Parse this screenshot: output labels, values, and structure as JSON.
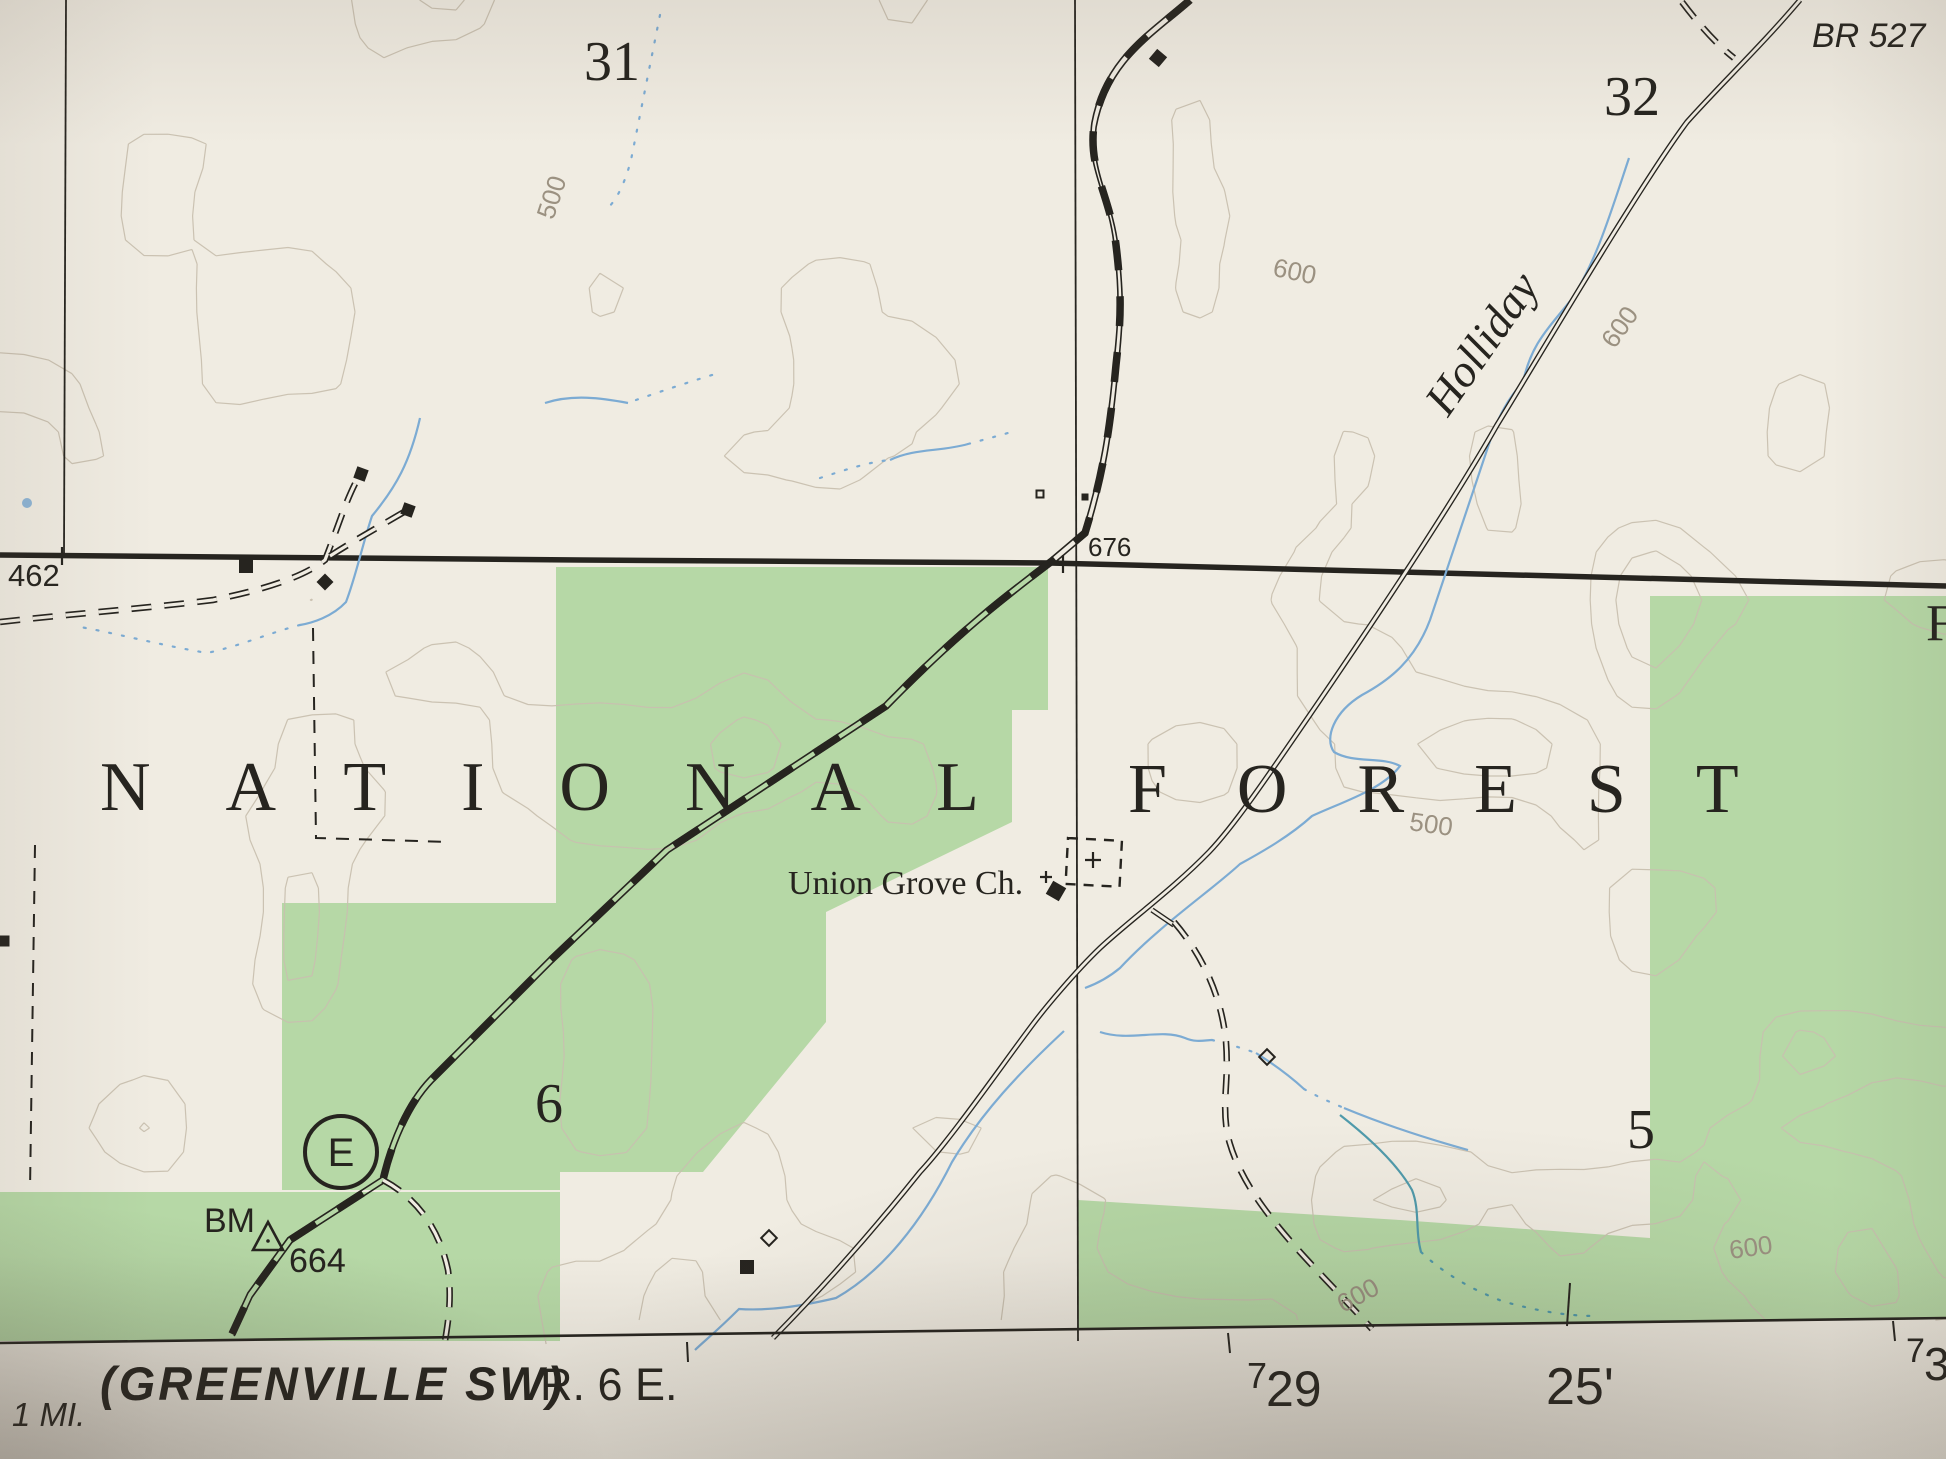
{
  "map": {
    "colors": {
      "paper": "#f0ece2",
      "paper_margin": "#efece3",
      "forest_green": "#b6d8a6",
      "contour": "#c8c0af",
      "contour_index": "#a89d89",
      "contour_label": "#9b9181",
      "water": "#7cabd3",
      "water_teal": "#4f9aab",
      "ink": "#26241f"
    },
    "contour_field": {
      "seed": 11,
      "step": 24,
      "wavelength": 150,
      "levels": [
        0.34,
        0.42,
        0.5,
        0.58,
        0.66
      ],
      "index_level": 2
    },
    "forest_areas": [
      {
        "name": "forest-area-central",
        "points": [
          [
            556,
            567
          ],
          [
            1048,
            567
          ],
          [
            1048,
            710
          ],
          [
            1012,
            710
          ],
          [
            1012,
            822
          ],
          [
            826,
            912
          ],
          [
            826,
            1022
          ],
          [
            703,
            1172
          ],
          [
            556,
            1172
          ]
        ]
      },
      {
        "name": "forest-area-west-column",
        "points": [
          [
            282,
            903
          ],
          [
            560,
            903
          ],
          [
            560,
            1190
          ],
          [
            282,
            1190
          ]
        ]
      },
      {
        "name": "forest-area-southwest-band",
        "points": [
          [
            0,
            1192
          ],
          [
            560,
            1192
          ],
          [
            560,
            1341
          ],
          [
            0,
            1341
          ]
        ]
      },
      {
        "name": "forest-area-east",
        "points": [
          [
            1650,
            596
          ],
          [
            1946,
            596
          ],
          [
            1946,
            1240
          ],
          [
            1650,
            1240
          ]
        ]
      },
      {
        "name": "forest-area-southeast-band",
        "points": [
          [
            1078,
            1200
          ],
          [
            1400,
            1220
          ],
          [
            1650,
            1238
          ],
          [
            1946,
            1238
          ],
          [
            1946,
            1318
          ],
          [
            1078,
            1330
          ]
        ]
      }
    ],
    "lines": [
      {
        "name": "landline-heavy",
        "cls": "heavy",
        "d": "M0,555 L580,560 L1050,563 L1946,586"
      },
      {
        "name": "section-line-west",
        "cls": "thin",
        "d": "M66,0 L64,553"
      },
      {
        "name": "section-line-central",
        "cls": "thin",
        "d": "M1075,0 L1078,1341"
      },
      {
        "name": "boundary-dashed-west",
        "cls": "dashbound",
        "d": "M35,845 L30,1190"
      },
      {
        "name": "boundary-dashed-mid",
        "cls": "dashbound",
        "d": "M313,628 L316,838 L450,842"
      },
      {
        "name": "stream-upper-left",
        "cls": "stream-int",
        "d": "M660,15 C651,60 641,110 631,160 C623,190 613,205 604,211"
      },
      {
        "name": "stream-left",
        "cls": "stream",
        "d": "M420,418 C410,462 396,487 372,516 C362,546 356,576 346,602 C332,617 312,623 300,625"
      },
      {
        "name": "stream-left-dotted",
        "cls": "stream-int",
        "d": "M300,625 C272,632 240,646 207,653 C160,645 110,632 80,627"
      },
      {
        "name": "stream-center-small",
        "cls": "stream",
        "d": "M545,403 C572,394 602,398 628,403"
      },
      {
        "name": "stream-center-dotted",
        "cls": "stream-int",
        "d": "M636,400 C665,390 695,380 722,372"
      },
      {
        "name": "stream-mid",
        "cls": "stream",
        "d": "M890,460 C915,448 940,452 968,444"
      },
      {
        "name": "stream-mid-dotted",
        "cls": "stream-int",
        "d": "M820,478 C845,470 868,462 890,460 M968,444 C990,438 1005,434 1018,430"
      },
      {
        "name": "stream-holliday",
        "cls": "stream",
        "d": "M1629,158 C1610,215 1596,262 1571,300 C1546,331 1531,345 1523,382 C1507,400 1500,415 1493,432 C1470,500 1450,560 1430,620 C1415,660 1390,680 1362,695 C1334,712 1324,738 1334,752 C1354,764 1382,756 1400,766 C1382,790 1342,802 1312,816 C1290,836 1262,852 1240,864 C1212,890 1160,925 1120,968 C1108,978 1096,984 1085,988"
      },
      {
        "name": "stream-road-bottom",
        "cls": "stream",
        "d": "M1064,1031 C1020,1072 982,1112 952,1162 C922,1222 882,1272 836,1298 C802,1306 770,1311 739,1309 C717,1331 702,1343 695,1350"
      },
      {
        "name": "stream-east-wavy",
        "cls": "stream",
        "d": "M1100,1032 C1130,1042 1160,1028 1185,1038 C1196,1043 1206,1040 1212,1040"
      },
      {
        "name": "stream-east-dots-1",
        "cls": "stream-int",
        "d": "M1212,1040 C1228,1044 1242,1048 1256,1053"
      },
      {
        "name": "stream-east-2",
        "cls": "stream",
        "d": "M1256,1053 C1275,1065 1292,1078 1304,1089"
      },
      {
        "name": "stream-east-dots-2",
        "cls": "stream-int",
        "d": "M1304,1089 C1318,1097 1330,1102 1344,1108"
      },
      {
        "name": "stream-east-3",
        "cls": "stream",
        "d": "M1344,1108 C1385,1125 1425,1138 1468,1150"
      },
      {
        "name": "stream-green-teal",
        "cls": "stream-teal",
        "d": "M1340,1115 C1372,1140 1398,1165 1412,1190 C1420,1210 1415,1230 1421,1252"
      },
      {
        "name": "stream-green-teal-2",
        "cls": "stream-teal-int",
        "d": "M1421,1252 C1442,1272 1470,1289 1502,1301 C1540,1312 1570,1316 1596,1316"
      },
      {
        "name": "railroad",
        "cls": "railroad",
        "d": "M1190,0 C1150,35 1106,60 1094,125 C1088,170 1110,195 1116,245 C1122,295 1121,320 1116,365 C1110,430 1103,475 1085,533 L1052,561 C1010,593 960,630 886,706 L667,850 L553,958 L431,1080 C407,1105 391,1145 383,1180 L290,1240 L250,1295 L232,1334"
      },
      {
        "name": "road-holliday",
        "cls": "road",
        "d": "M1800,0 C1762,45 1720,85 1687,122 C1640,185 1540,355 1497,425 C1460,490 1395,590 1320,700 C1270,773 1235,825 1209,852 C1172,890 1130,920 1100,948 C1075,972 1045,1008 1033,1024 C1000,1068 950,1140 920,1172 C880,1222 830,1280 773,1338"
      },
      {
        "name": "road-spur-church",
        "cls": "road",
        "d": "M1152,910 L1174,925"
      },
      {
        "name": "road-unimproved-top",
        "cls": "droad",
        "d": "M1682,2 C1697,22 1716,44 1734,58"
      },
      {
        "name": "road-unimproved-east",
        "cls": "droad",
        "d": "M1174,922 C1205,958 1222,1000 1226,1042 C1229,1082 1222,1100 1227,1132 C1232,1158 1247,1185 1263,1207 C1292,1247 1330,1283 1372,1329"
      },
      {
        "name": "road-unimproved-west",
        "cls": "droad",
        "d": "M0,622 C80,613 150,608 213,600 C262,590 302,578 325,560 C337,530 345,502 358,478"
      },
      {
        "name": "road-unimproved-west-branch",
        "cls": "droad",
        "d": "M330,556 C355,540 382,525 404,512"
      },
      {
        "name": "road-unimproved-rr-branch",
        "cls": "droad",
        "d": "M383,1180 C420,1200 440,1232 448,1270 C452,1300 448,1322 445,1341"
      }
    ],
    "buildings": [
      {
        "name": "building",
        "x": 1158,
        "y": 58,
        "s": 11,
        "rot": 40,
        "filled": true
      },
      {
        "name": "building",
        "x": 361,
        "y": 474,
        "s": 10,
        "rot": 20,
        "filled": true
      },
      {
        "name": "building",
        "x": 408,
        "y": 510,
        "s": 10,
        "rot": 20,
        "filled": true
      },
      {
        "name": "building",
        "x": 325,
        "y": 582,
        "s": 10,
        "rot": 45,
        "filled": true
      },
      {
        "name": "building",
        "x": 246,
        "y": 566,
        "s": 12,
        "rot": 0,
        "filled": true
      },
      {
        "name": "building",
        "x": 747,
        "y": 1267,
        "s": 12,
        "rot": 0,
        "filled": true
      },
      {
        "name": "building-church",
        "x": 1056,
        "y": 891,
        "s": 13,
        "rot": 30,
        "filled": true
      },
      {
        "name": "building-open",
        "x": 769,
        "y": 1238,
        "s": 11,
        "rot": 45,
        "filled": false
      },
      {
        "name": "building-open",
        "x": 1267,
        "y": 1057,
        "s": 11,
        "rot": 45,
        "filled": false
      },
      {
        "name": "building-open",
        "x": 1040,
        "y": 494,
        "s": 7,
        "rot": 0,
        "filled": false
      },
      {
        "name": "building-small",
        "x": 1085,
        "y": 497,
        "s": 5,
        "rot": 0,
        "filled": true
      },
      {
        "name": "building-small",
        "x": 4,
        "y": 941,
        "s": 9,
        "rot": 0,
        "filled": true
      }
    ],
    "crosses": [
      {
        "name": "section-corner-cross",
        "x": 62,
        "y": 556,
        "s": 9
      },
      {
        "name": "section-corner-cross",
        "x": 1063,
        "y": 564,
        "s": 9
      },
      {
        "name": "cemetery-cross",
        "x": 1093,
        "y": 860,
        "s": 8
      },
      {
        "name": "church-cross",
        "x": 1046,
        "y": 877,
        "s": 6
      }
    ],
    "cemetery": {
      "name": "cemetery-outline",
      "x": 1068,
      "y": 838,
      "w": 54,
      "h": 46,
      "rot": 3
    },
    "route_marker": {
      "name": "route-marker-E",
      "cx": 341,
      "cy": 1152,
      "r": 36,
      "label": "E"
    },
    "benchmark_triangle": {
      "name": "benchmark-triangle",
      "points": [
        [
          268,
          1222
        ],
        [
          253,
          1250
        ],
        [
          283,
          1250
        ]
      ],
      "dot": [
        268,
        1241
      ]
    },
    "water_dot": {
      "name": "spring-dot",
      "x": 27,
      "y": 503,
      "r": 5
    },
    "neatline": {
      "name": "neatline",
      "d": "M0,1343 L1946,1318"
    },
    "ticks": [
      {
        "name": "grid-tick",
        "d": "M687,1342 L688,1362"
      },
      {
        "name": "grid-tick",
        "d": "M1228,1333 L1230,1353"
      },
      {
        "name": "grid-tick",
        "d": "M1893,1321 L1895,1341"
      },
      {
        "name": "grid-tick-interior",
        "d": "M1570,1283 L1567,1326"
      }
    ],
    "labels": [
      {
        "name": "section-number-31",
        "text": "31",
        "x": 612,
        "y": 80,
        "size": 56,
        "font": "serif",
        "anchor": "middle"
      },
      {
        "name": "section-number-32",
        "text": "32",
        "x": 1632,
        "y": 115,
        "size": 56,
        "font": "serif",
        "anchor": "middle"
      },
      {
        "name": "section-number-6",
        "text": "6",
        "x": 549,
        "y": 1122,
        "size": 56,
        "font": "serif",
        "anchor": "middle"
      },
      {
        "name": "section-number-5",
        "text": "5",
        "x": 1641,
        "y": 1148,
        "size": 56,
        "font": "serif",
        "anchor": "middle"
      },
      {
        "name": "forest-name-line1",
        "text": "NATIONAL",
        "x": 100,
        "y": 810,
        "size": 70,
        "font": "serif",
        "spacing": 75
      },
      {
        "name": "forest-name-line2",
        "text": "FOREST",
        "x": 1128,
        "y": 812,
        "size": 70,
        "font": "serif",
        "spacing": 70
      },
      {
        "name": "spot-elevation-676",
        "text": "676",
        "x": 1088,
        "y": 556,
        "size": 26,
        "font": "sans"
      },
      {
        "name": "spot-elevation-462",
        "text": "462",
        "x": 8,
        "y": 586,
        "size": 31,
        "font": "sans"
      },
      {
        "name": "bridge-label-br527",
        "text": "BR 527",
        "x": 1812,
        "y": 47,
        "size": 34,
        "font": "sans",
        "italic": true
      },
      {
        "name": "creek-name-holliday",
        "text": "Holliday",
        "x": 1448,
        "y": 418,
        "size": 46,
        "font": "serif",
        "italic": true,
        "rotate": -55
      },
      {
        "name": "church-name",
        "text": "Union Grove Ch.",
        "x": 788,
        "y": 894,
        "size": 34,
        "font": "serif"
      },
      {
        "name": "benchmark-bm",
        "text": "BM",
        "x": 204,
        "y": 1232,
        "size": 34,
        "font": "sans"
      },
      {
        "name": "benchmark-664",
        "text": "664",
        "x": 289,
        "y": 1272,
        "size": 34,
        "font": "sans"
      },
      {
        "name": "route-letter",
        "text": "E",
        "x": 341,
        "y": 1166,
        "size": 40,
        "font": "sans",
        "anchor": "middle"
      },
      {
        "name": "edge-letter-f",
        "text": "F",
        "x": 1926,
        "y": 640,
        "size": 52,
        "font": "serif"
      },
      {
        "name": "contour-label-500",
        "text": "500",
        "x": 560,
        "y": 200,
        "size": 26,
        "font": "sans",
        "rotate": -72,
        "contour": true,
        "anchor": "middle"
      },
      {
        "name": "contour-label-600",
        "text": "600",
        "x": 1293,
        "y": 280,
        "size": 26,
        "font": "sans",
        "rotate": 12,
        "contour": true,
        "anchor": "middle"
      },
      {
        "name": "contour-label-600",
        "text": "600",
        "x": 1627,
        "y": 332,
        "size": 26,
        "font": "sans",
        "rotate": -55,
        "contour": true,
        "anchor": "middle"
      },
      {
        "name": "contour-label-500",
        "text": "500",
        "x": 1430,
        "y": 833,
        "size": 26,
        "font": "sans",
        "rotate": 8,
        "contour": true,
        "anchor": "middle"
      },
      {
        "name": "contour-label-600",
        "text": "600",
        "x": 1362,
        "y": 1303,
        "size": 26,
        "font": "sans",
        "rotate": -28,
        "contour": true,
        "anchor": "middle"
      },
      {
        "name": "contour-label-600",
        "text": "600",
        "x": 1752,
        "y": 1256,
        "size": 26,
        "font": "sans",
        "rotate": -8,
        "contour": true,
        "anchor": "middle"
      }
    ],
    "margin_labels": [
      {
        "name": "adjoining-quad-name",
        "text": "(GREENVILLE SW)",
        "x": 100,
        "y": 1400,
        "size": 47,
        "font": "sans",
        "italic": true,
        "weight": "bold",
        "spacing": 3
      },
      {
        "name": "range-label",
        "text": "R. 6 E.",
        "x": 540,
        "y": 1400,
        "size": 45,
        "font": "sans"
      },
      {
        "name": "scale-note-1mi",
        "text": "1 MI.",
        "x": 12,
        "y": 1426,
        "size": 33,
        "font": "sans",
        "italic": true
      },
      {
        "name": "grid-number-729-prefix",
        "text": "7",
        "x": 1247,
        "y": 1388,
        "size": 36,
        "font": "sans"
      },
      {
        "name": "grid-number-729",
        "text": "29",
        "x": 1266,
        "y": 1406,
        "size": 50,
        "font": "sans"
      },
      {
        "name": "grid-minutes-25",
        "text": "25'",
        "x": 1546,
        "y": 1404,
        "size": 52,
        "font": "sans"
      },
      {
        "name": "grid-number-730-prefix",
        "text": "7",
        "x": 1906,
        "y": 1362,
        "size": 34,
        "font": "sans"
      },
      {
        "name": "grid-number-730",
        "text": "30",
        "x": 1924,
        "y": 1380,
        "size": 46,
        "font": "sans"
      }
    ]
  }
}
